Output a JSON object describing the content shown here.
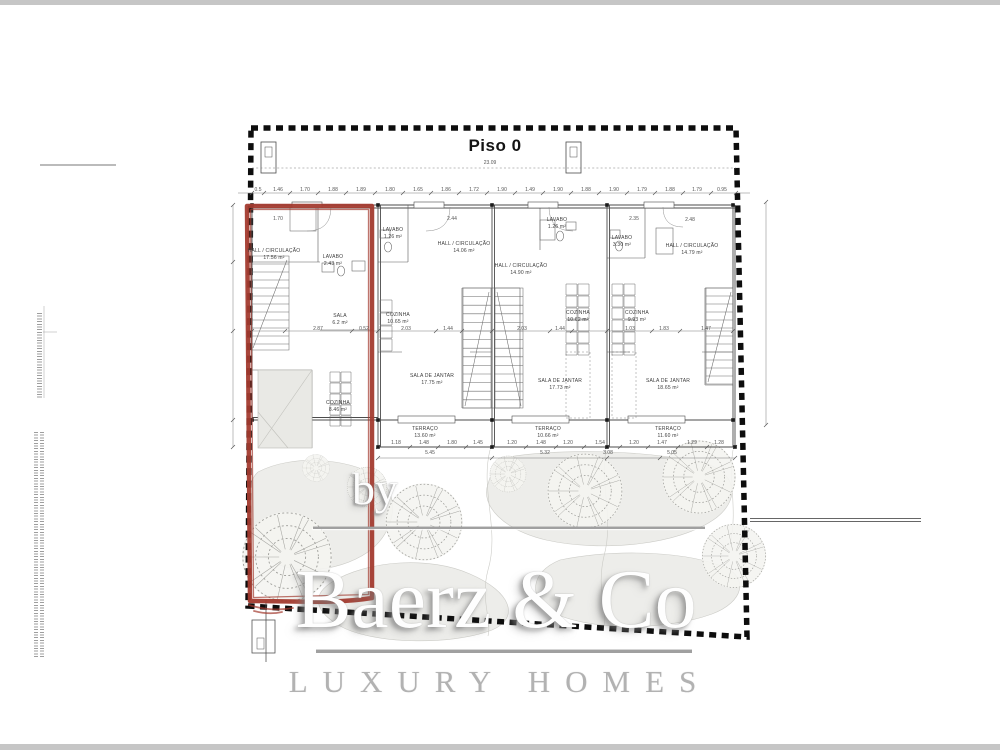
{
  "page": {
    "title": "Piso 0"
  },
  "watermark": {
    "by": "by",
    "brand": "Baerz & Co",
    "tagline": "LUXURY HOMES"
  },
  "colors": {
    "highlight_red": "#a33b2f",
    "boundary_black": "#0d0d0d",
    "plan_line": "#4b4b4b",
    "watermark_gray": "#b2b2b2"
  },
  "plan": {
    "rooms": [
      {
        "unit": "1",
        "name": "HALL / CIRCULAÇÃO",
        "area": "17.56 m²",
        "x": 274,
        "y": 248
      },
      {
        "unit": "1",
        "name": "LAVABO",
        "area": "2.43 m²",
        "x": 333,
        "y": 254
      },
      {
        "unit": "1",
        "name": "SALA",
        "area": "6.2 m²",
        "x": 340,
        "y": 313
      },
      {
        "unit": "1",
        "name": "COZINHA",
        "area": "8.46 m²",
        "x": 338,
        "y": 400
      },
      {
        "unit": "2",
        "name": "LAVABO",
        "area": "1.26 m²",
        "x": 393,
        "y": 227
      },
      {
        "unit": "2",
        "name": "HALL / CIRCULAÇÃO",
        "area": "14.06 m²",
        "x": 464,
        "y": 241
      },
      {
        "unit": "2",
        "name": "COZINHA",
        "area": "10.65 m²",
        "x": 398,
        "y": 312
      },
      {
        "unit": "2",
        "name": "SALA DE JANTAR",
        "area": "17.75 m²",
        "x": 432,
        "y": 373
      },
      {
        "unit": "2",
        "name": "TERRAÇO",
        "area": "13.60 m²",
        "x": 425,
        "y": 426
      },
      {
        "unit": "3",
        "name": "LAVABO",
        "area": "1.26 m²",
        "x": 557,
        "y": 217
      },
      {
        "unit": "3",
        "name": "HALL / CIRCULAÇÃO",
        "area": "14.90 m²",
        "x": 521,
        "y": 263
      },
      {
        "unit": "3",
        "name": "COZINHA",
        "area": "10.62 m²",
        "x": 578,
        "y": 310
      },
      {
        "unit": "3",
        "name": "SALA DE JANTAR",
        "area": "17.73 m²",
        "x": 560,
        "y": 378
      },
      {
        "unit": "3",
        "name": "TERRAÇO",
        "area": "10.66 m²",
        "x": 548,
        "y": 426
      },
      {
        "unit": "4",
        "name": "LAVABO",
        "area": "3.30 m²",
        "x": 622,
        "y": 235
      },
      {
        "unit": "4",
        "name": "HALL / CIRCULAÇÃO",
        "area": "14.79 m²",
        "x": 692,
        "y": 243
      },
      {
        "unit": "4",
        "name": "COZINHA",
        "area": "9.93 m²",
        "x": 637,
        "y": 310
      },
      {
        "unit": "4",
        "name": "SALA DE JANTAR",
        "area": "18.65 m²",
        "x": 668,
        "y": 378
      },
      {
        "unit": "4",
        "name": "TERRAÇO",
        "area": "11.60 m²",
        "x": 668,
        "y": 426
      }
    ],
    "dim_labels": [
      {
        "t": "23.09",
        "x": 490,
        "y": 163
      },
      {
        "t": "0.5",
        "x": 258,
        "y": 190
      },
      {
        "t": "1.46",
        "x": 278,
        "y": 190
      },
      {
        "t": "1.70",
        "x": 305,
        "y": 190
      },
      {
        "t": "1.88",
        "x": 333,
        "y": 190
      },
      {
        "t": "1.89",
        "x": 361,
        "y": 190
      },
      {
        "t": "1.80",
        "x": 390,
        "y": 190
      },
      {
        "t": "1.65",
        "x": 418,
        "y": 190
      },
      {
        "t": "1.86",
        "x": 446,
        "y": 190
      },
      {
        "t": "1.72",
        "x": 474,
        "y": 190
      },
      {
        "t": "1.90",
        "x": 502,
        "y": 190
      },
      {
        "t": "1.49",
        "x": 530,
        "y": 190
      },
      {
        "t": "1.90",
        "x": 558,
        "y": 190
      },
      {
        "t": "1.88",
        "x": 586,
        "y": 190
      },
      {
        "t": "1.90",
        "x": 614,
        "y": 190
      },
      {
        "t": "1.79",
        "x": 642,
        "y": 190
      },
      {
        "t": "1.88",
        "x": 670,
        "y": 190
      },
      {
        "t": "1.79",
        "x": 697,
        "y": 190
      },
      {
        "t": "0.95",
        "x": 722,
        "y": 190
      },
      {
        "t": "1.70",
        "x": 278,
        "y": 219
      },
      {
        "t": "2.44",
        "x": 452,
        "y": 219
      },
      {
        "t": "2.35",
        "x": 634,
        "y": 219
      },
      {
        "t": "2.48",
        "x": 690,
        "y": 220
      },
      {
        "t": "2.87",
        "x": 318,
        "y": 329
      },
      {
        "t": "0.52",
        "x": 364,
        "y": 329
      },
      {
        "t": "2.03",
        "x": 406,
        "y": 329
      },
      {
        "t": "1.44",
        "x": 448,
        "y": 329
      },
      {
        "t": "2.03",
        "x": 522,
        "y": 329
      },
      {
        "t": "1.44",
        "x": 560,
        "y": 329
      },
      {
        "t": "1.03",
        "x": 630,
        "y": 329
      },
      {
        "t": "1.83",
        "x": 664,
        "y": 329
      },
      {
        "t": "1.47",
        "x": 706,
        "y": 329
      },
      {
        "t": "1.18",
        "x": 396,
        "y": 443
      },
      {
        "t": "1.48",
        "x": 424,
        "y": 443
      },
      {
        "t": "1.80",
        "x": 452,
        "y": 443
      },
      {
        "t": "1.45",
        "x": 478,
        "y": 443
      },
      {
        "t": "1.20",
        "x": 512,
        "y": 443
      },
      {
        "t": "1.48",
        "x": 541,
        "y": 443
      },
      {
        "t": "1.20",
        "x": 568,
        "y": 443
      },
      {
        "t": "1.54",
        "x": 600,
        "y": 443
      },
      {
        "t": "1.20",
        "x": 634,
        "y": 443
      },
      {
        "t": "1.47",
        "x": 662,
        "y": 443
      },
      {
        "t": "1.29",
        "x": 692,
        "y": 443
      },
      {
        "t": "1.28",
        "x": 719,
        "y": 443
      },
      {
        "t": "5.45",
        "x": 430,
        "y": 453
      },
      {
        "t": "5.32",
        "x": 545,
        "y": 453
      },
      {
        "t": "3.08",
        "x": 608,
        "y": 453
      },
      {
        "t": "5.05",
        "x": 672,
        "y": 453
      }
    ]
  }
}
